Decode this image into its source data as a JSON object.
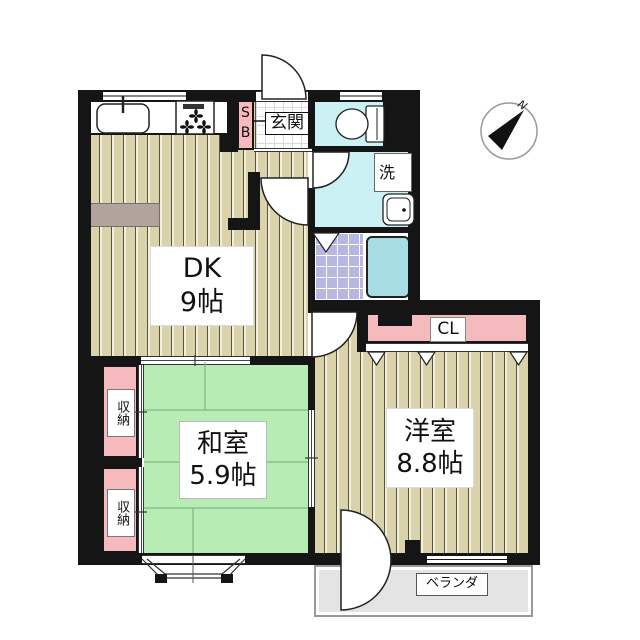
{
  "floorplan": {
    "rooms": {
      "dk": {
        "name": "DK",
        "size": "9帖"
      },
      "japanese_room": {
        "name": "和室",
        "size": "5.9帖"
      },
      "western_room": {
        "name": "洋室",
        "size": "8.8帖"
      },
      "entrance": {
        "label": "玄関"
      },
      "shoe_box": {
        "line1": "S",
        "line2": "B"
      },
      "laundry": {
        "label": "洗"
      },
      "closet": {
        "label": "CL"
      },
      "storage_upper": {
        "label": "収納"
      },
      "storage_lower": {
        "label": "収納"
      },
      "veranda": {
        "label": "ベランダ"
      }
    },
    "compass": {
      "north_label": "N"
    },
    "colors": {
      "wall": "#151515",
      "wood_floor": "#d9d2ab",
      "tatami_green": "#b7edb5",
      "accent_pink": "#f6b9be",
      "sanitary_cyan": "#ccf1f5",
      "bathtub_cyan": "#a9dde4",
      "bath_floor_lavender": "#b7b7e2",
      "veranda_gray": "#e4e4e4"
    }
  }
}
